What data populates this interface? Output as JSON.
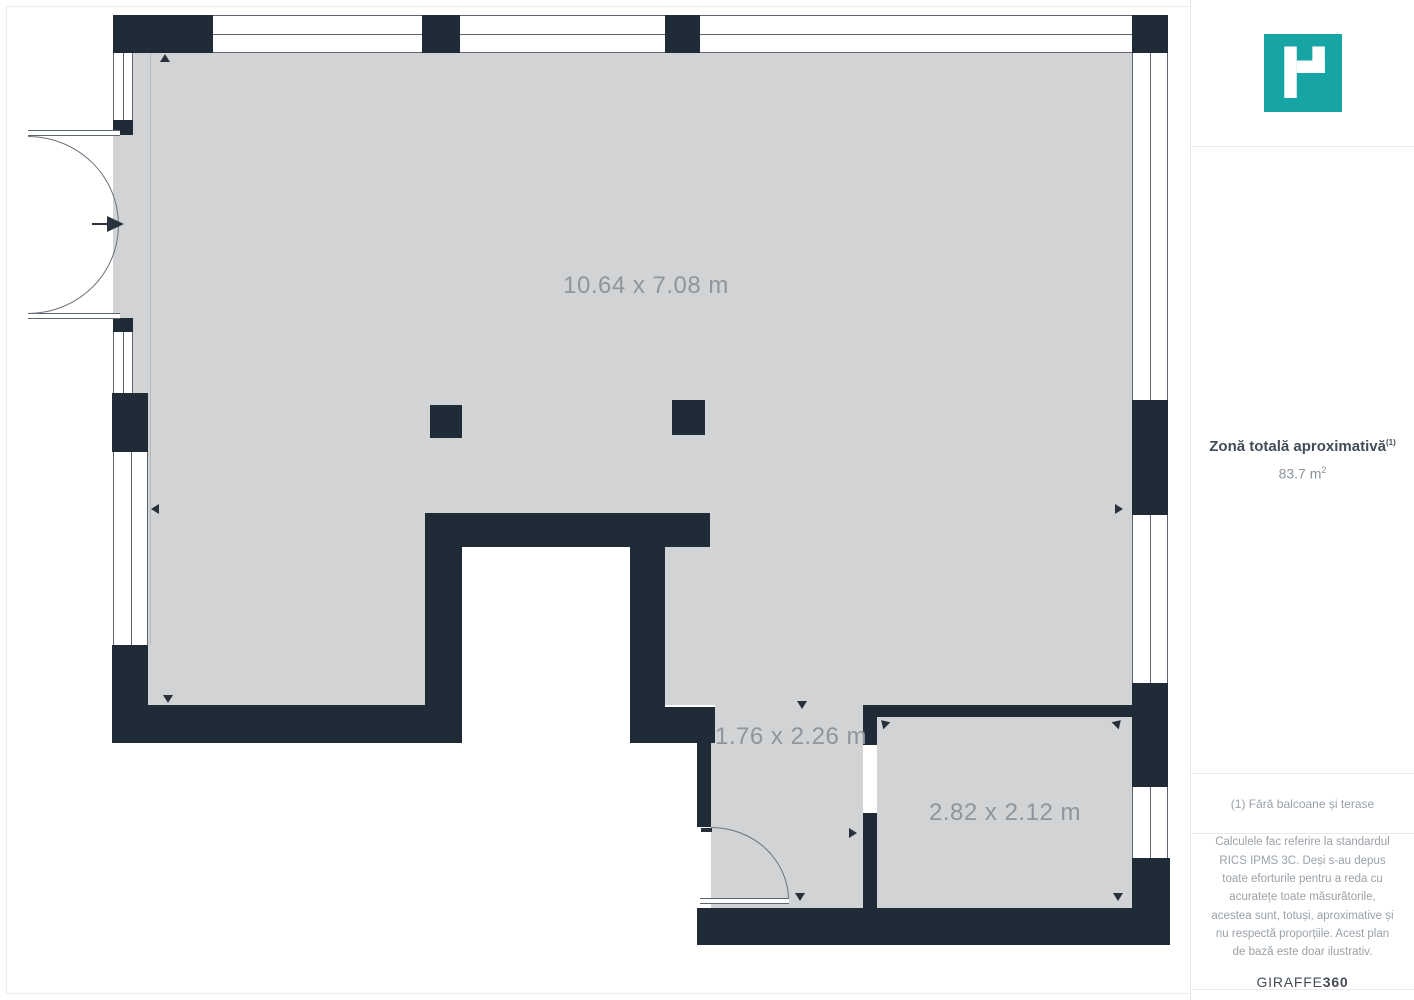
{
  "floor_plan": {
    "rooms": [
      {
        "name": "main-room",
        "dimensions_label": "10.64 x 7.08 m"
      },
      {
        "name": "hallway",
        "dimensions_label": "1.76 x 2.26 m"
      },
      {
        "name": "small-room",
        "dimensions_label": "2.82 x 2.12 m"
      }
    ],
    "colors": {
      "wall": "#202b38",
      "floor": "#d2d3d4",
      "frame_line": "#5d6670",
      "dimension_text": "#8e959d"
    }
  },
  "sidebar": {
    "logo": {
      "icon": "giraffe360-logo-icon",
      "color": "#17a4a4"
    },
    "total_area": {
      "title": "Zonă totală aproximativă",
      "title_superscript": "(1)",
      "value": "83.7 m",
      "value_superscript": "2"
    },
    "footnote": "(1) Fără balcoane și terase",
    "disclaimer": "Calculele fac referire la standardul RICS IPMS 3C. Deși s-au depus toate eforturile pentru a reda cu acuratețe toate măsurătorile, acestea sunt, totuși, aproximative și nu respectă proporțiile. Acest plan de bază este doar ilustrativ.",
    "brand": {
      "name": "GIRAFFE",
      "suffix": "360"
    }
  }
}
